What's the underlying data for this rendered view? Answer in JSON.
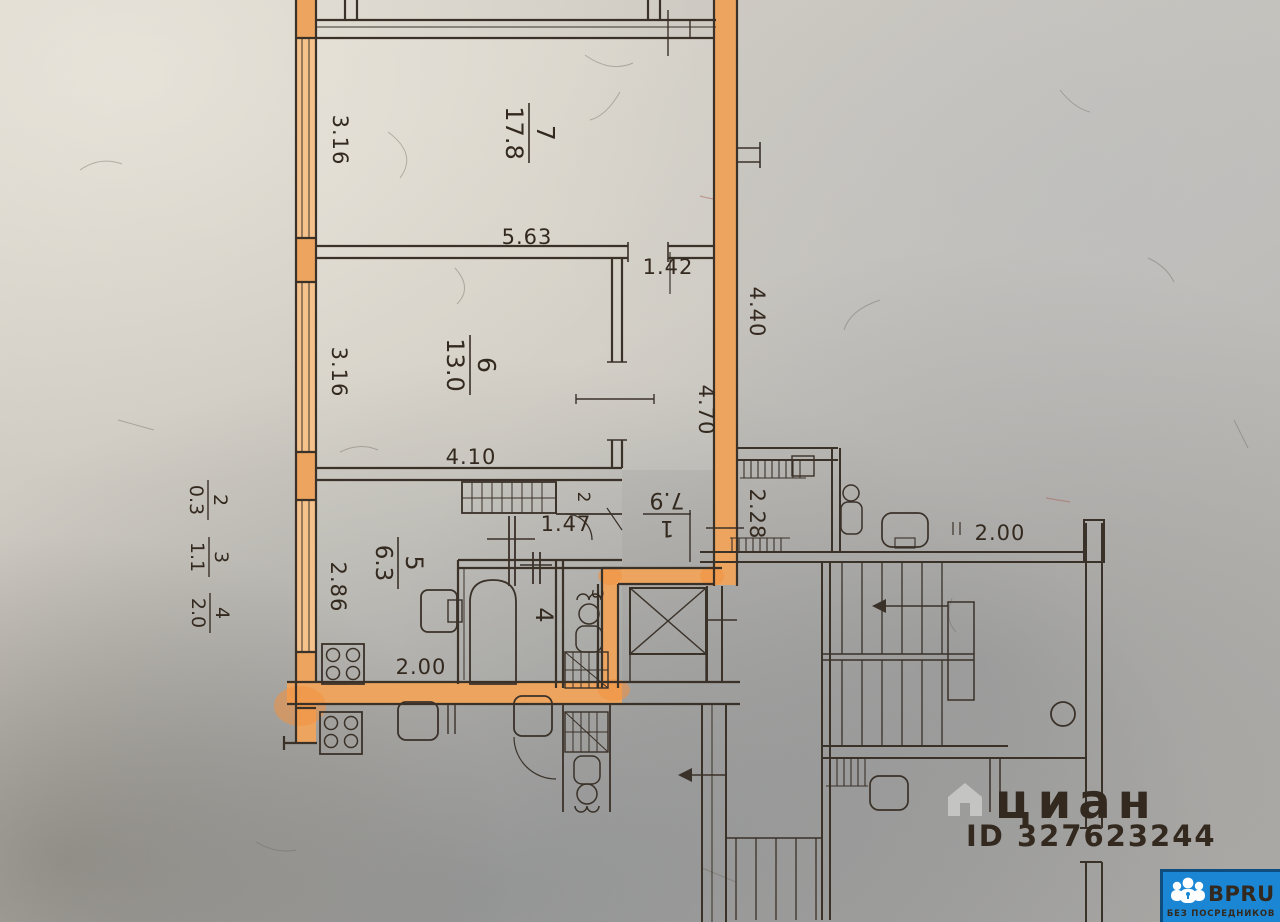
{
  "plan": {
    "rooms": [
      {
        "number": "7",
        "area": "17.8"
      },
      {
        "number": "6",
        "area": "13.0"
      },
      {
        "number": "5",
        "area": "6.3"
      },
      {
        "number": "1",
        "area": "7.9"
      },
      {
        "number": "4",
        "area": ""
      },
      {
        "number": "3",
        "area": ""
      },
      {
        "number": "2",
        "area": ""
      }
    ],
    "balcony_marks": [
      {
        "number": "2",
        "area": "0.3"
      },
      {
        "number": "3",
        "area": "1.1"
      },
      {
        "number": "4",
        "area": "2.0"
      }
    ],
    "dims": {
      "room7_width": "3.16",
      "room7_length": "5.63",
      "room6_width": "3.16",
      "room6_length": "4.10",
      "corridor_width": "1.42",
      "corridor_length": "4.70",
      "right_wall": "4.40",
      "kitchen_entry": "1.47",
      "kitchen_width": "2.86",
      "kitchen_length": "2.00",
      "stair_hall": "2.28",
      "landing": "2.00"
    },
    "colors": {
      "highlight": "#eda45f",
      "ink": "#3a3129"
    }
  },
  "watermark": {
    "brand": "циан",
    "id_text": "ID 327623244"
  },
  "badge": {
    "brand": "BPRU",
    "tagline": "БЕЗ ПОСРЕДНИКОВ",
    "background": "#1b87d4"
  }
}
